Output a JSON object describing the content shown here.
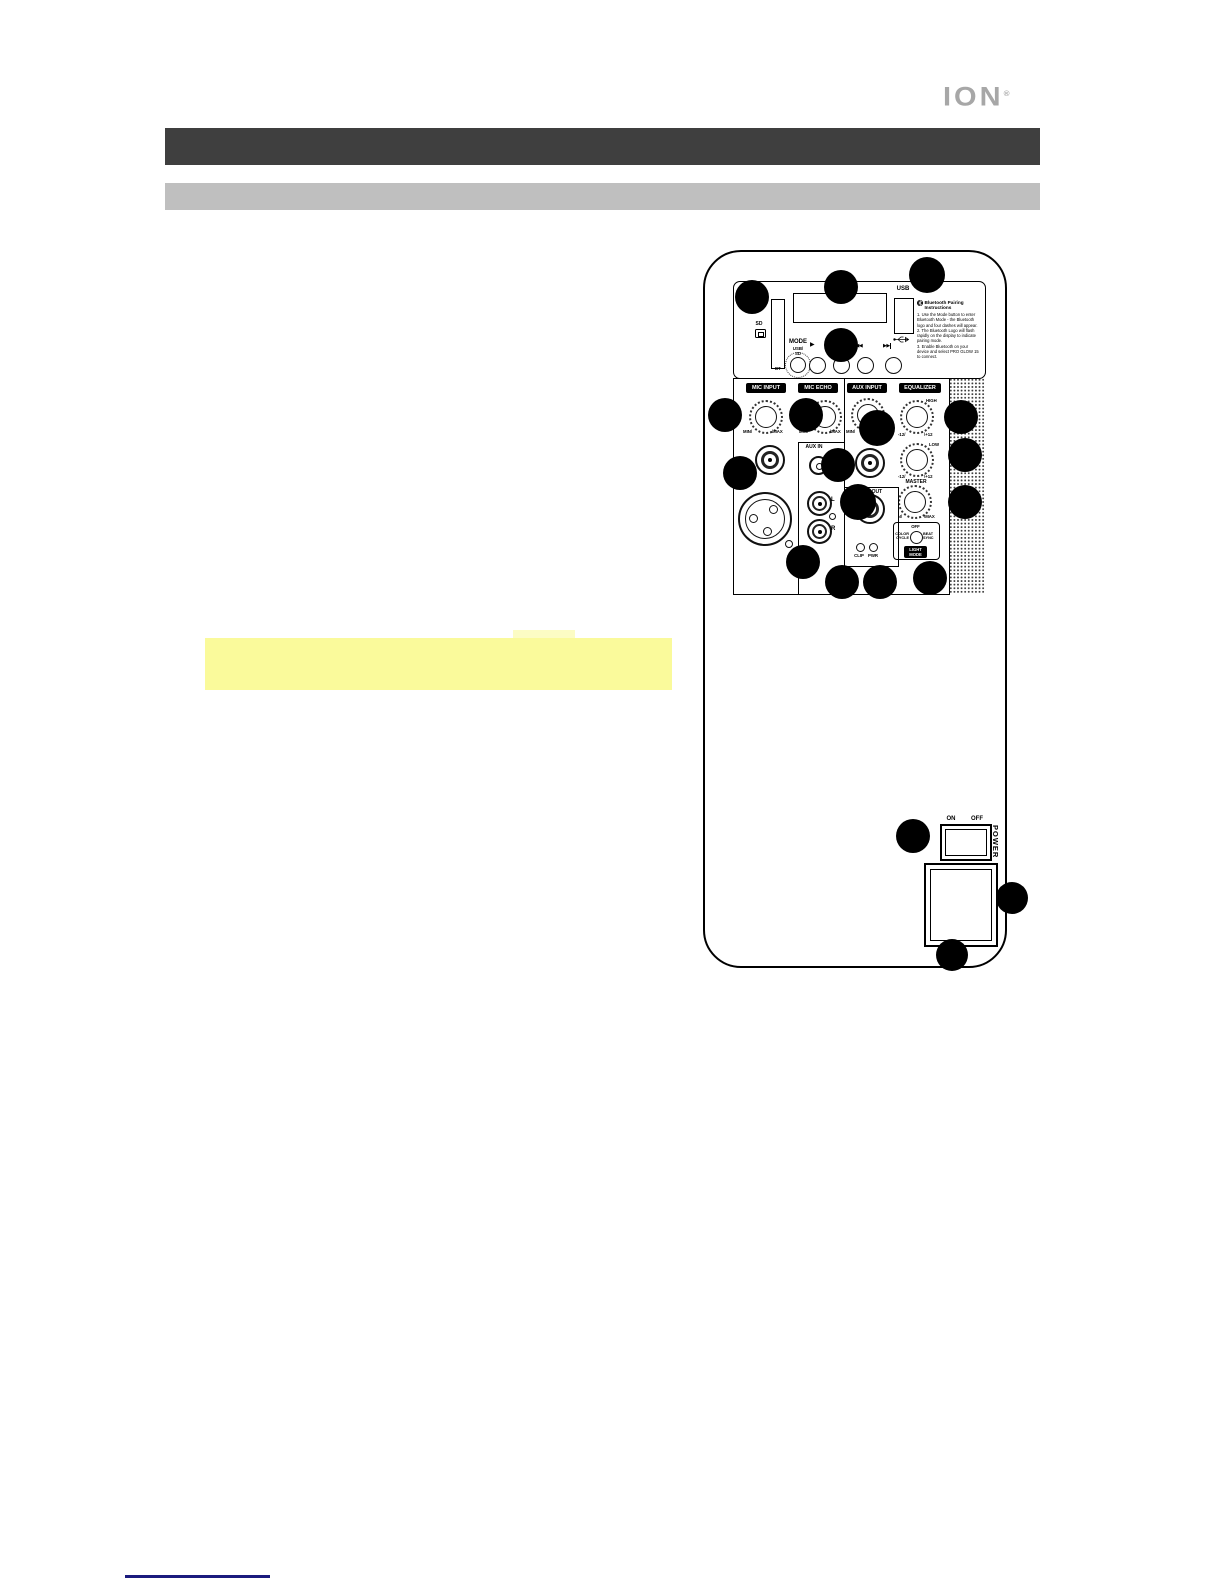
{
  "brand": {
    "logo": "ION",
    "mark": "®"
  },
  "knob_labels": {
    "min": "MIN/",
    "max": "\\MAX",
    "minus12": "-12/",
    "plus12": "\\+12"
  },
  "media": {
    "sd_label": "SD",
    "usb_label": "USB",
    "mode_label": "MODE",
    "mode_usb_sd_1": "USB/",
    "mode_usb_sd_2": "SD",
    "mode_bt": "BT",
    "mode_fm": "FM",
    "play_icon": "▶",
    "prev_icon": "◀◀",
    "next_icon": "▶▶",
    "bluetooth": {
      "title_line1": "Bluetooth Pairing",
      "title_line2": "Instructions",
      "step1": "1. Use the Mode button to enter Bluetooth Mode - the Bluetooth logo and four dashes will appear.",
      "step2": "2. The Bluetooth Logo will flash rapidly on the display to indicate pairing mode.",
      "step3": "3. Enable Bluetooth on your device and select PRO GLOW 15 to connect."
    }
  },
  "mixer": {
    "section_mic_input": "MIC INPUT",
    "section_mic_echo": "MIC ECHO",
    "section_aux_input": "AUX INPUT",
    "section_equalizer": "EQUALIZER",
    "aux_in_label": "AUX IN",
    "rca_left": "L",
    "rca_right": "R",
    "line_out_label": "LINE OUT",
    "led_clip": "CLIP",
    "led_pwr": "PWR",
    "eq_high": "HIGH",
    "eq_low": "LOW",
    "master": "MASTER",
    "light_mode": {
      "off": "OFF",
      "color_line1": "COLOR",
      "color_line2": "CYCLE",
      "beat_line1": "BEAT",
      "beat_line2": "SYNC",
      "badge_line1": "LIGHT",
      "badge_line2": "MODE"
    }
  },
  "power": {
    "on": "ON",
    "off": "OFF",
    "label": "POWER"
  },
  "colors": {
    "header_bar": "#3f3f3f",
    "subheader_bar": "#bfbfbf",
    "highlight": "#fafa9b",
    "logo_gray": "#a7a7a7",
    "footer_line": "#1b1b7e"
  }
}
